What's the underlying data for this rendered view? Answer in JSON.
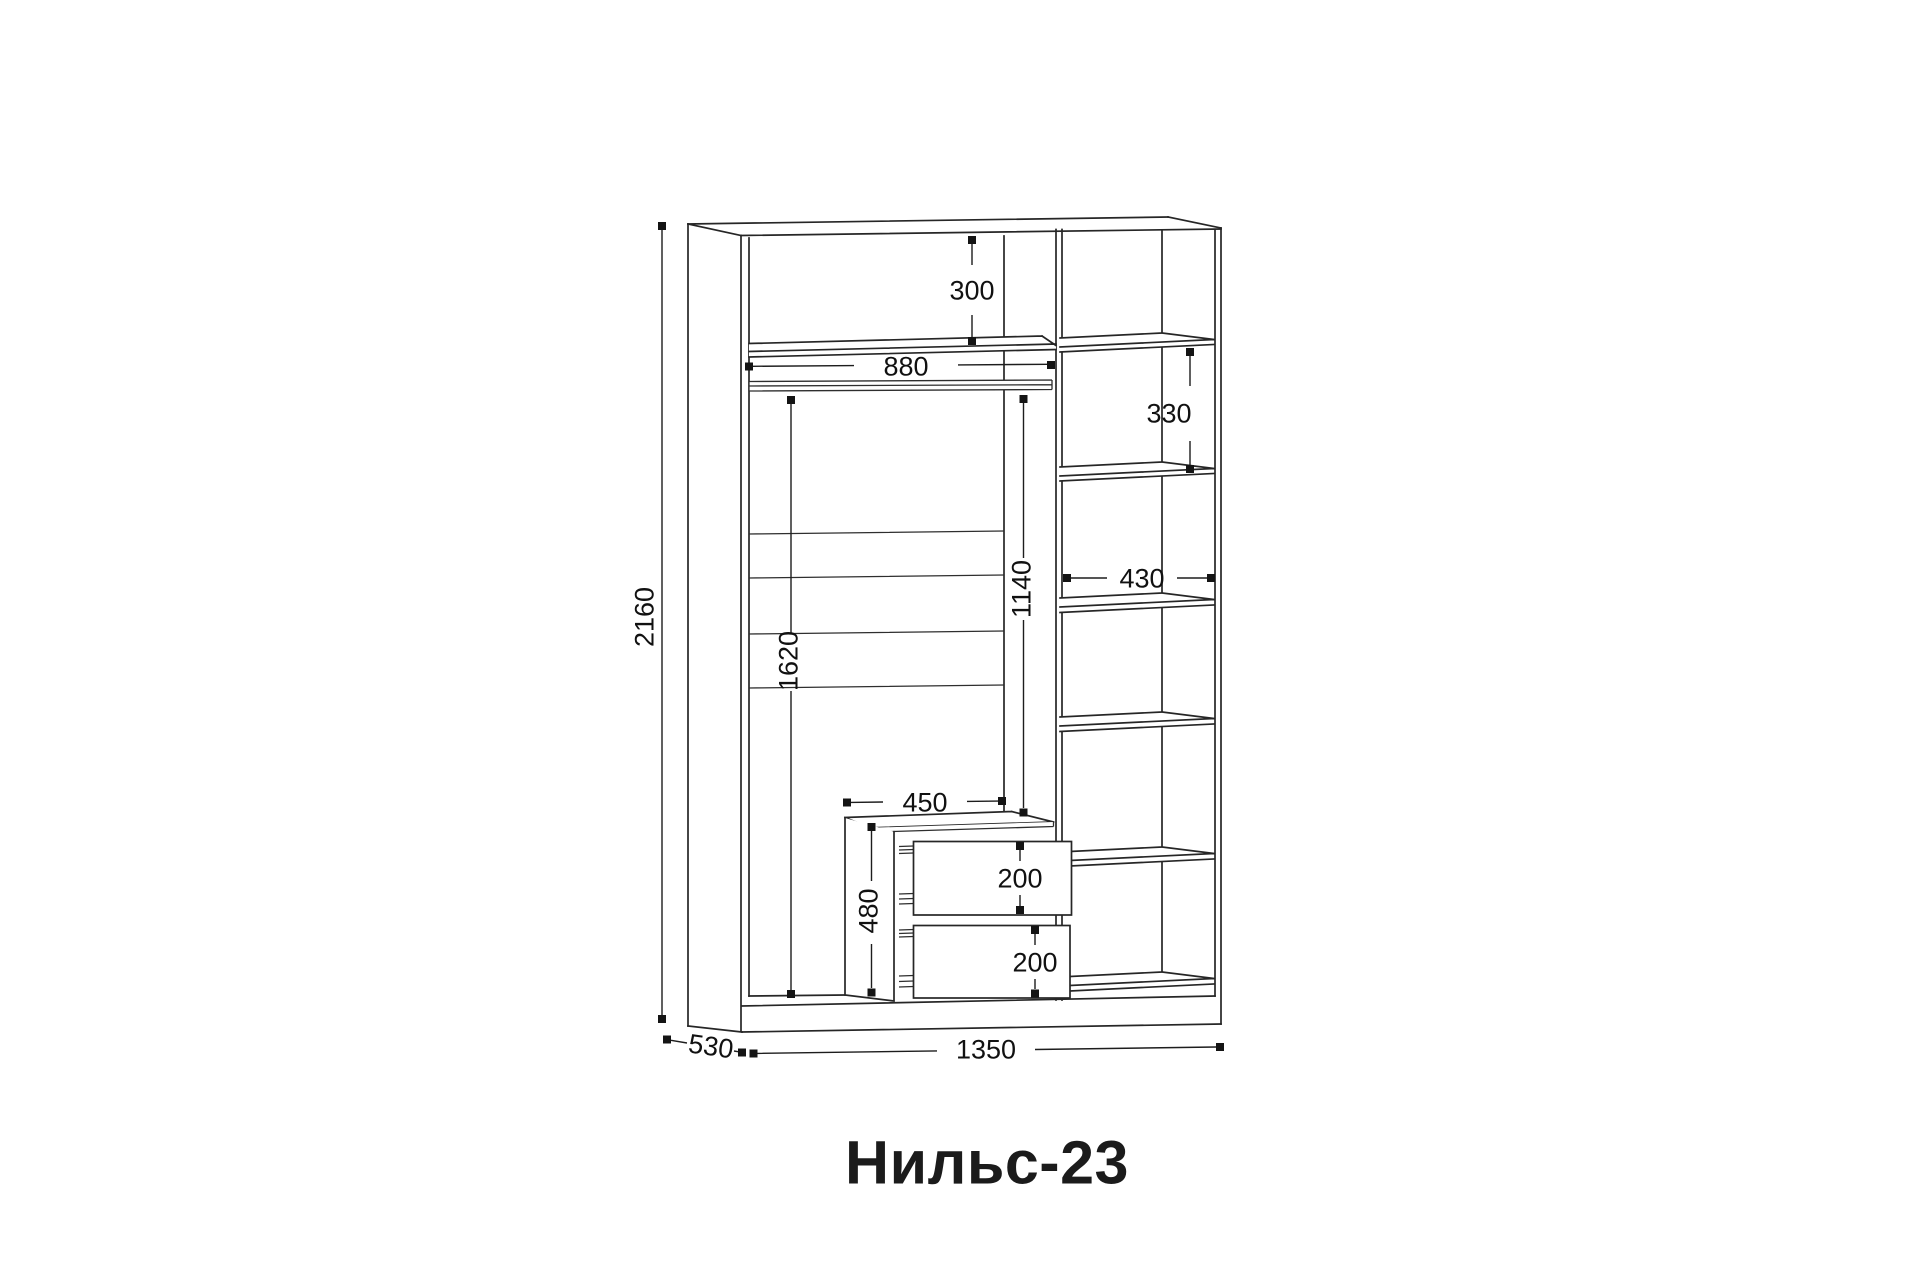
{
  "title": "Нильс-23",
  "dims": {
    "total_height": "2160",
    "total_width": "1350",
    "total_depth": "530",
    "top_shelf_offset": "300",
    "rod_length": "880",
    "right_shelf_gap": "330",
    "right_shelf_width": "430",
    "rod_to_drawer_height": "1140",
    "hanging_zone_height": "1620",
    "drawer_width": "450",
    "drawer_unit_height": "480",
    "drawer_top_height": "200",
    "drawer_bottom_height": "200"
  }
}
